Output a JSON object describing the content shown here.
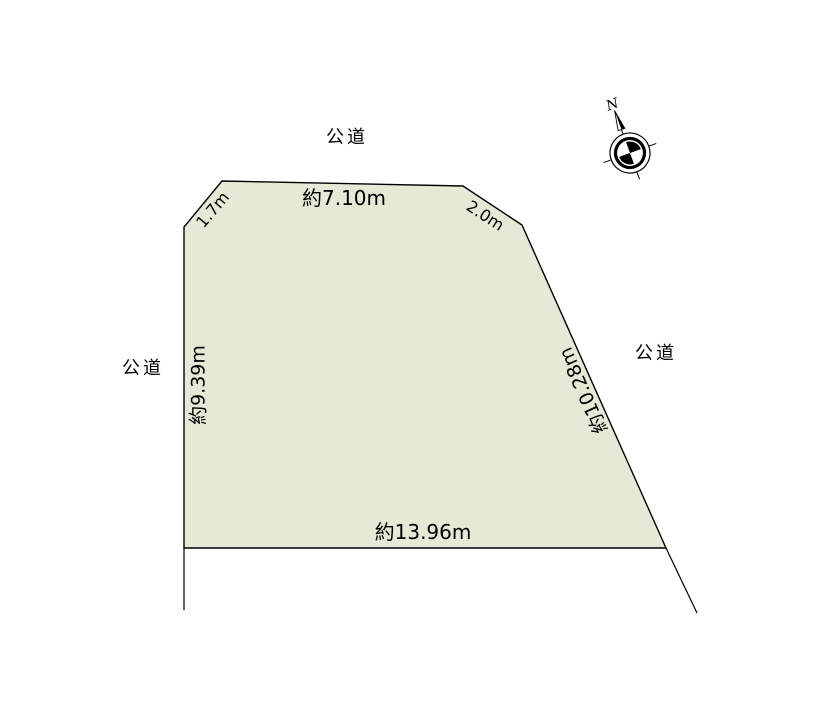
{
  "diagram": {
    "roads": {
      "top": "公道",
      "left": "公道",
      "right": "公道"
    },
    "measurements": {
      "top_edge": "約7.10m",
      "top_left_corner": "1.7m",
      "top_right_corner": "2.0m",
      "left_edge": "約9.39m",
      "right_edge": "約10.28m",
      "bottom_edge": "約13.96m"
    },
    "compass": {
      "north_label": "N"
    },
    "colors": {
      "parcel_fill": "#e4ead6",
      "line": "#000000"
    }
  }
}
